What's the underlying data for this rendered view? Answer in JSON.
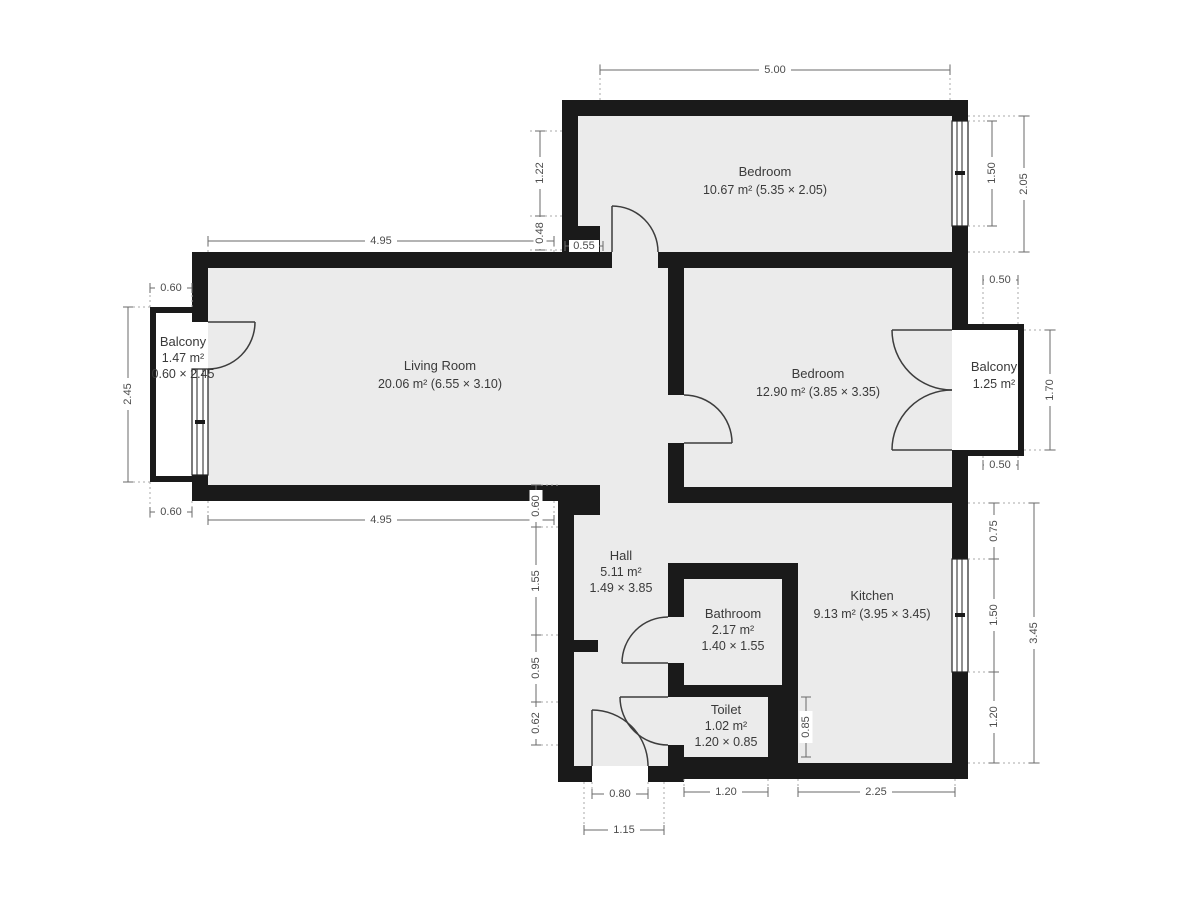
{
  "plan": {
    "rooms": {
      "bedroom_top": {
        "name": "Bedroom",
        "info": "10.67 m² (5.35 × 2.05)"
      },
      "living_room": {
        "name": "Living Room",
        "info": "20.06 m² (6.55 × 3.10)"
      },
      "bedroom_right": {
        "name": "Bedroom",
        "info": "12.90 m² (3.85 × 3.35)"
      },
      "kitchen": {
        "name": "Kitchen",
        "info": "9.13 m² (3.95 × 3.45)"
      },
      "hall": {
        "name": "Hall",
        "area": "5.11 m²",
        "size": "1.49 × 3.85"
      },
      "bathroom": {
        "name": "Bathroom",
        "area": "2.17 m²",
        "size": "1.40 × 1.55"
      },
      "toilet": {
        "name": "Toilet",
        "area": "1.02 m²",
        "size": "1.20 × 0.85"
      },
      "balcony_left": {
        "name": "Balcony",
        "area": "1.47 m²",
        "size": "0.60 × 2.45"
      },
      "balcony_right": {
        "name": "Balcony",
        "area": "1.25 m²"
      }
    },
    "dims": {
      "bedroom_top_width": "5.00",
      "bedroom_top_window": "1.50",
      "bedroom_top_depth": "2.05",
      "notch_height": "1.22",
      "notch_offset": "0.48",
      "notch_width": "0.55",
      "living_top_width": "4.95",
      "living_bottom_width": "4.95",
      "balcony_left_depth_top": "0.60",
      "balcony_left_length": "2.45",
      "balcony_left_depth_bottom": "0.60",
      "hall_step": "0.60",
      "hall_seg_upper": "1.55",
      "hall_seg_mid": "0.95",
      "hall_seg_lower": "0.62",
      "entry_door_width": "0.80",
      "entry_total_width": "1.15",
      "toilet_width": "1.20",
      "kitchen_bottom_width": "2.25",
      "toilet_depth": "0.85",
      "kitchen_right_upper": "0.75",
      "kitchen_window": "1.50",
      "kitchen_right_lower": "1.20",
      "kitchen_depth": "3.45",
      "balcony_right_depth_top": "0.50",
      "balcony_right_length": "1.70",
      "balcony_right_depth_bottom": "0.50"
    },
    "colors": {
      "wall": "#1a1a1a",
      "floor": "#ebebeb",
      "background": "#ffffff"
    }
  }
}
